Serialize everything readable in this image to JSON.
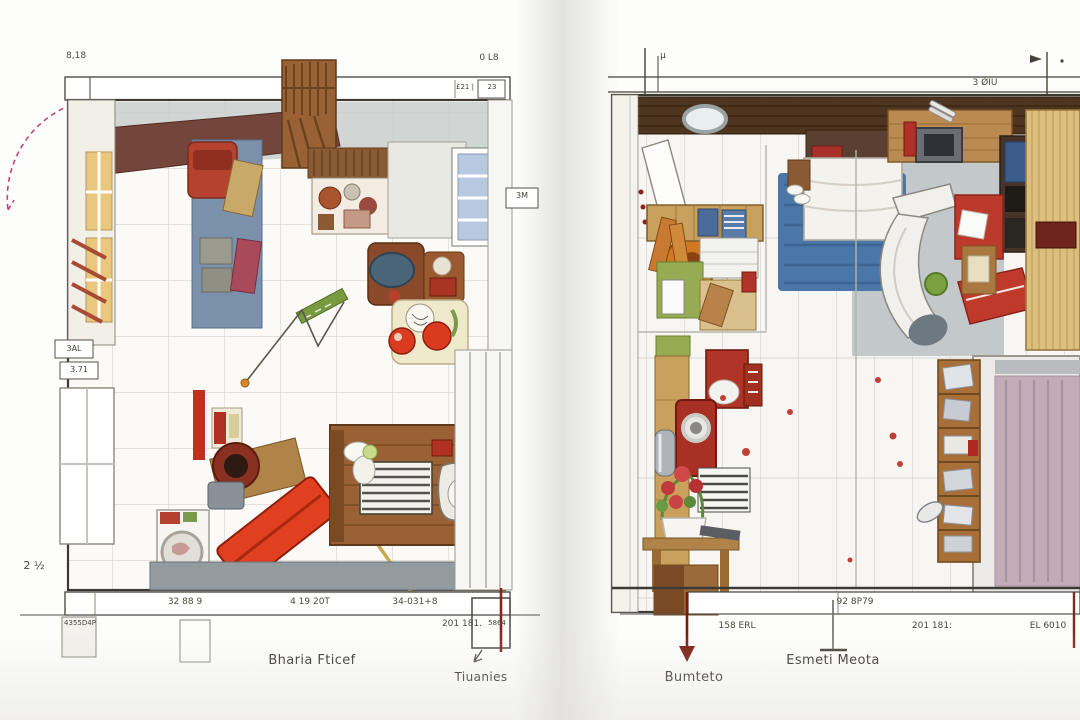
{
  "left_plan": {
    "caption": "Bharia Fticef",
    "callout": "Tiuanies",
    "dim_top_left": "8,18",
    "dim_top_right": "0 L8",
    "dim_strip_a": "£21 |",
    "dim_strip_b": "23",
    "tag_wall": "3M",
    "tag_side_a": "3AL",
    "tag_side_b": "3.71",
    "dim_side": "2 ½",
    "dim_bottom_a": "32 88 9",
    "dim_bottom_b": "4 19 20T",
    "dim_bottom_c": "34-031+8",
    "dim_bottom_d": "201 181.",
    "tag_bottom_left": "4355D4P",
    "tag_bottom_right": "5864"
  },
  "right_plan": {
    "caption_arrow": "Bumteto",
    "caption_mid": "Esmeti Meota",
    "dim_top_tick": "μ",
    "dim_top_right": "3 ØIU",
    "dim_strip": "92 8P79",
    "dim_bottom_a": "158 ERL",
    "dim_bottom_b": "201 181:",
    "dim_bottom_c": "EL 6010"
  },
  "colors": {
    "accent_red": "#b5402e",
    "dark_red_annotation": "#7a1a12",
    "magenta_door_swing": "#c2457a",
    "wood": "#a9743f",
    "blue_rug": "#4a77a8",
    "dim_line": "#44413a",
    "floor_grey": "#939b9f"
  }
}
